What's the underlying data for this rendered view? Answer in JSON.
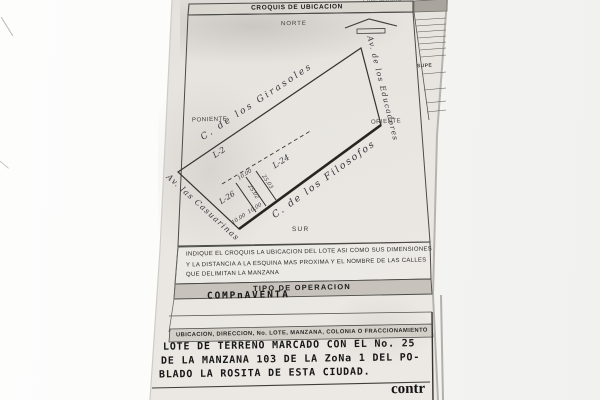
{
  "photo": {
    "paper_color": "#e9e6e1",
    "background_left": "#fdfdfc",
    "background_right": "#f1f1ef",
    "ink_color": "#3b3b3b"
  },
  "header": {
    "propietario_partial": "PROPIETARIO",
    "croquis_title": "CROQUIS DE UBICACION"
  },
  "compass": {
    "norte": "NORTE",
    "sur": "SUR",
    "poniente": "PONIENTE",
    "oriente": "ORIENTE"
  },
  "streets": {
    "north": "C. de los Girasoles",
    "east": "Av. de los Educadores",
    "south": "C. de los Filosofos",
    "west": "Av. las Casuarinas"
  },
  "lots": {
    "back_lot": "L-2",
    "right_lot": "L-24",
    "left_lot": "L-26"
  },
  "dimensions": {
    "front_width": "10.00",
    "depth_right": "25.03",
    "depth_left": "25.02",
    "front_pair": "10.00  10.00"
  },
  "side_table": {
    "superficie_partial": "SUPE"
  },
  "instructions": {
    "line1": "INDIQUE EL CROQUIS LA UBICACION DEL LOTE ASI COMO SUS DIMENSIONES",
    "line2": "Y LA DISTANCIA A LA ESQUINA MAS PROXIMA Y EL NOMBRE DE LAS CALLES",
    "line3": "QUE DELIMITAN LA MANZANA"
  },
  "tipo_operacion": {
    "label": "TIPO DE OPERACION",
    "value": "COMPnAVENTA"
  },
  "ubicacion": {
    "label": "UBICACION, DIRECCION, No. LOTE, MANZANA, COLONIA O FRACCIONAMIENTO",
    "line1": "LOTE DE TERRENO MARCADO CON EL No. 25",
    "line2": "DE LA MANZANA 103 DE LA ZoNa 1 DEL PO-",
    "line3": "BLADO LA ROSITA DE ESTA CIUDAD."
  },
  "footer": {
    "partial_word": "contr"
  }
}
